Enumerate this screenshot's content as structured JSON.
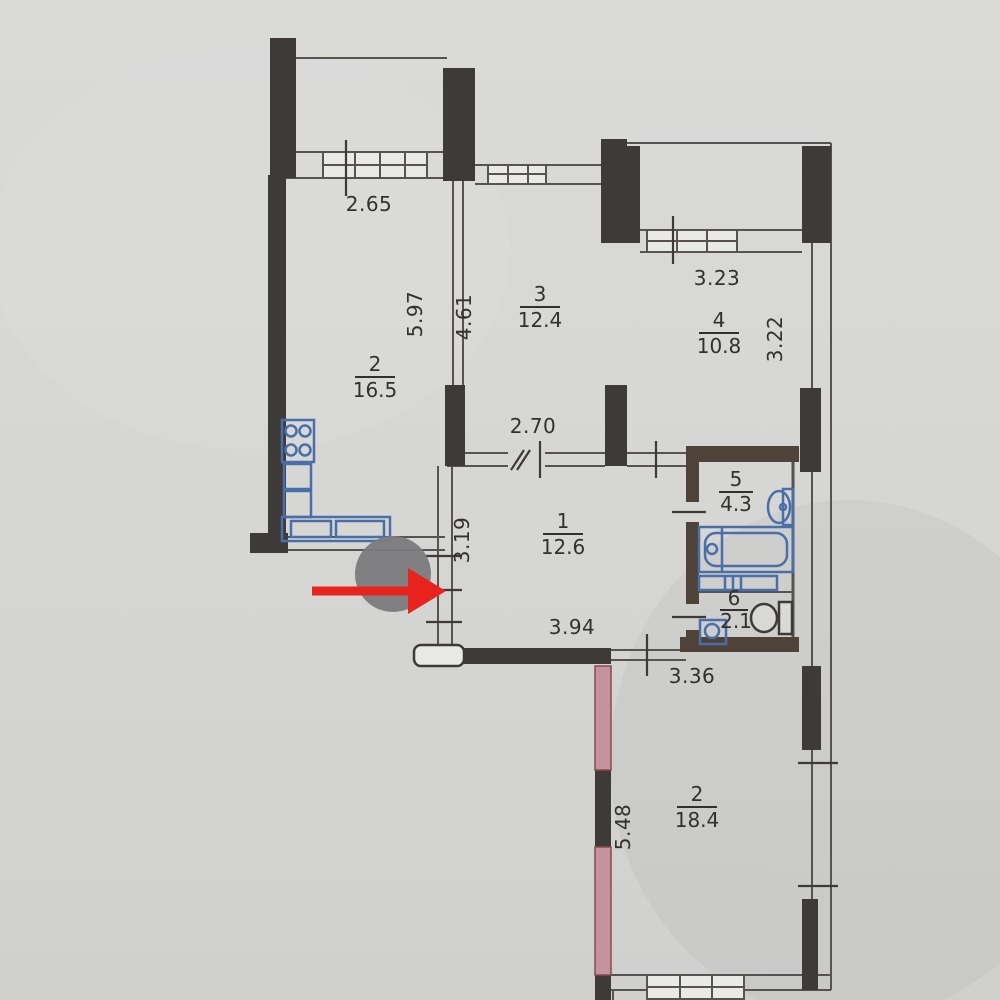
{
  "plan": {
    "kind": "apartment-floor-plan-scan",
    "rooms": [
      {
        "key": "kitchen",
        "number": "2",
        "area": "16.5"
      },
      {
        "key": "room-3",
        "number": "3",
        "area": "12.4"
      },
      {
        "key": "room-4",
        "number": "4",
        "area": "10.8"
      },
      {
        "key": "hallway",
        "number": "1",
        "area": "12.6"
      },
      {
        "key": "bathroom",
        "number": "5",
        "area": "4.3"
      },
      {
        "key": "toilet",
        "number": "6",
        "area": "2.1"
      },
      {
        "key": "lower-room",
        "number": "2",
        "area": "18.4"
      }
    ],
    "dimensions": [
      {
        "key": "kitchen-window-width",
        "value": "2.65",
        "orientation": "horizontal"
      },
      {
        "key": "kitchen-depth",
        "value": "5.97",
        "orientation": "vertical"
      },
      {
        "key": "room3-depth",
        "value": "4.61",
        "orientation": "vertical"
      },
      {
        "key": "room4-balcony-width",
        "value": "3.23",
        "orientation": "horizontal"
      },
      {
        "key": "room4-depth",
        "value": "3.22",
        "orientation": "vertical"
      },
      {
        "key": "hall-top-width",
        "value": "2.70",
        "orientation": "horizontal"
      },
      {
        "key": "hall-left-depth",
        "value": "3.19",
        "orientation": "vertical"
      },
      {
        "key": "hall-bottom-width",
        "value": "3.94",
        "orientation": "horizontal"
      },
      {
        "key": "lower-room-top-width",
        "value": "3.36",
        "orientation": "horizontal"
      },
      {
        "key": "lower-room-depth",
        "value": "5.48",
        "orientation": "vertical"
      }
    ],
    "marker": {
      "type": "click-target-annotation",
      "circle_color": "#7b7b7e",
      "arrow_color": "#e8231d"
    },
    "palette": {
      "paper": "#d6d6d4",
      "walls_dark": "#3e3a37",
      "walls_brown": "#4f4238",
      "walls_pink": "#c4939b",
      "walls_pink_stroke": "#8a4a50",
      "plumbing_blue": "#4a6fa8",
      "thin_line": "#57544f",
      "text": "#33312e"
    }
  }
}
